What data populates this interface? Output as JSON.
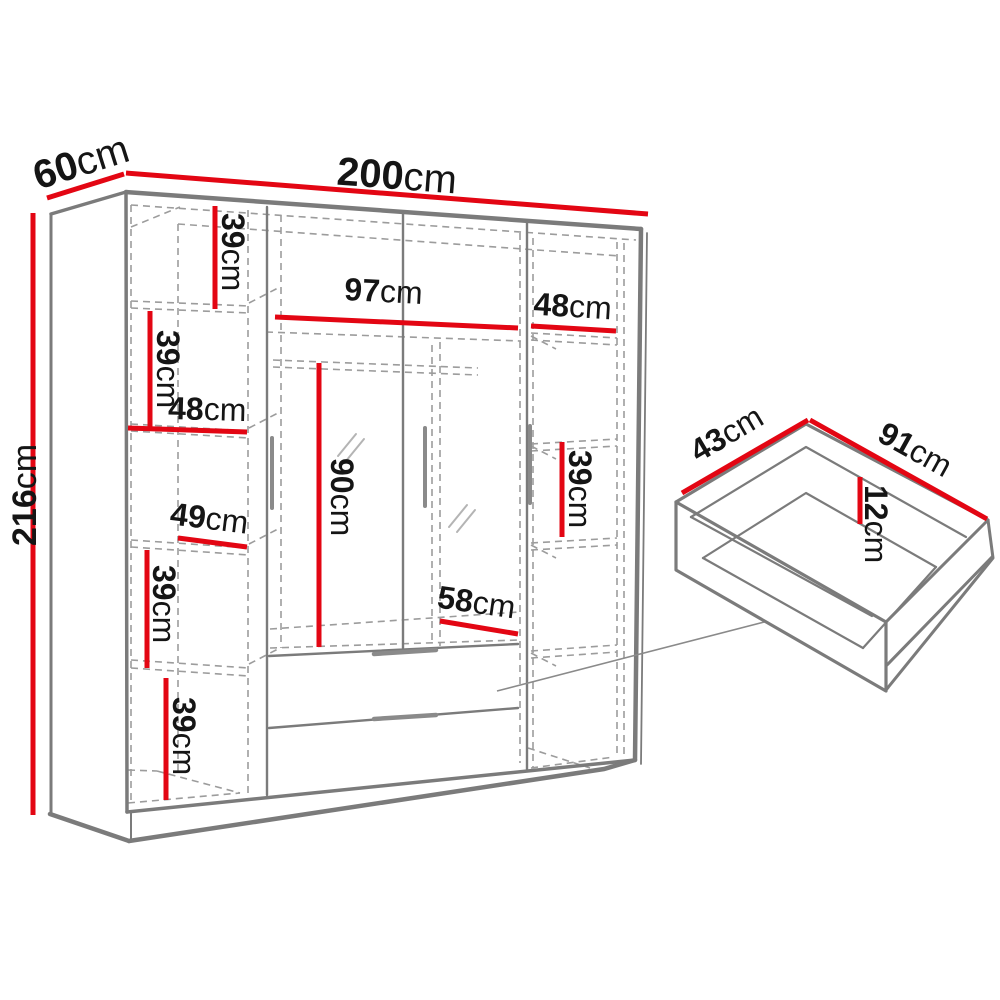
{
  "diagram_title": "wardrobe-dimensions-diagram",
  "colors": {
    "dimension_red": "#e30613",
    "structure_gray": "#7b7b7b",
    "dashed_gray": "#9c9c9c",
    "text_black": "#151515"
  },
  "wardrobe": {
    "overall": {
      "width": {
        "value": "200",
        "unit": "cm"
      },
      "depth": {
        "value": "60",
        "unit": "cm"
      },
      "height": {
        "value": "216",
        "unit": "cm"
      }
    },
    "left_column": {
      "shelf_1": {
        "value": "39",
        "unit": "cm"
      },
      "shelf_2": {
        "value": "39",
        "unit": "cm"
      },
      "width_upper": {
        "value": "48",
        "unit": "cm"
      },
      "width_lower": {
        "value": "49",
        "unit": "cm"
      },
      "shelf_3": {
        "value": "39",
        "unit": "cm"
      },
      "shelf_4": {
        "value": "39",
        "unit": "cm"
      }
    },
    "middle": {
      "width": {
        "value": "97",
        "unit": "cm"
      },
      "hanging_height": {
        "value": "90",
        "unit": "cm"
      },
      "bottom_width": {
        "value": "58",
        "unit": "cm"
      }
    },
    "right_column": {
      "width": {
        "value": "48",
        "unit": "cm"
      },
      "shelf": {
        "value": "39",
        "unit": "cm"
      }
    }
  },
  "drawer": {
    "depth": {
      "value": "43",
      "unit": "cm"
    },
    "width": {
      "value": "91",
      "unit": "cm"
    },
    "height": {
      "value": "12",
      "unit": "cm"
    }
  }
}
